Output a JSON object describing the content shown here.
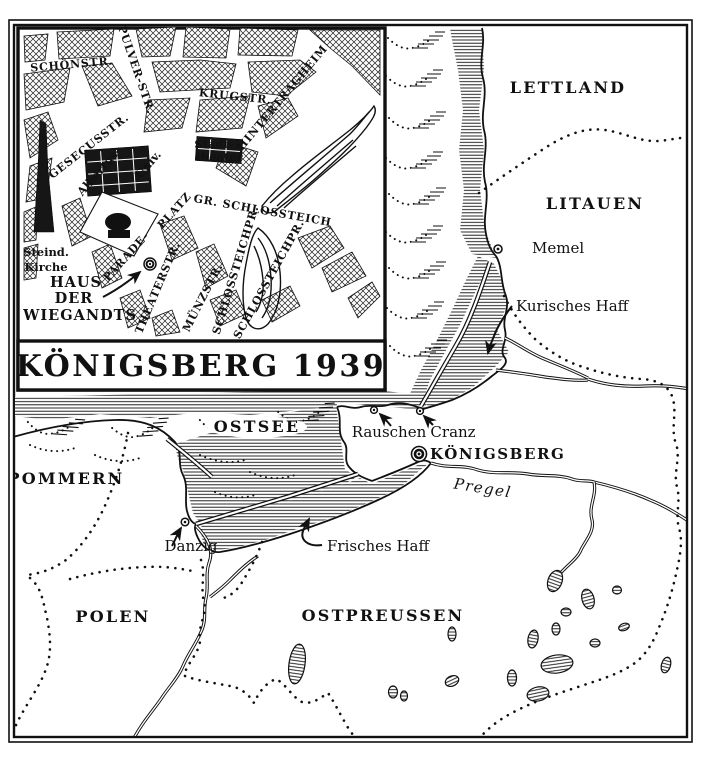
{
  "inset": {
    "title": "KÖNIGSBERG 1939",
    "streets": {
      "schoenstr": "SCHÖNSTR.",
      "pulverstr": "PULVER-STR.",
      "krugstr": "KRUGSTR.",
      "hintertragheim": "HINTERTRAGHEIM",
      "gesecusstr": "GESECUSSTR.",
      "gr_schlossteich": "GR. SCHLOSSTEICH",
      "theaterstr": "THEATERSTR.",
      "muenzstr": "MÜNZSTR.",
      "schlossteichpr_w": "SCHLOSSTEICHPR.",
      "schlossteichpr_e": "SCHLOSSTEICHPR.",
      "parade": "PARADE-",
      "platz": "PLATZ"
    },
    "places": {
      "stadt": "Stadt-",
      "theater": "theater",
      "albertus": "Albertus-",
      "univ": "Univ.",
      "steind": "Steind.",
      "kirche": "Kirche",
      "haus": "HAUS",
      "der": "DER",
      "wiegandts": "WIEGANDTS"
    }
  },
  "map": {
    "regions": {
      "lettland": "LETTLAND",
      "litauen": "LITAUEN",
      "pommern": "POMMERN",
      "polen": "POLEN",
      "ostpreussen": "OSTPREUSSEN",
      "ostsee": "OSTSEE"
    },
    "cities": {
      "memel": "Memel",
      "koenigsberg": "KÖNIGSBERG",
      "rauschen": "Rauschen",
      "cranz": "Cranz",
      "danzig": "Danzig"
    },
    "waters": {
      "kurisches_haff": "Kurisches Haff",
      "frisches_haff": "Frisches Haff",
      "pregel": "Pregel"
    }
  },
  "colors": {
    "ink": "#111111",
    "paper": "#ffffff"
  }
}
